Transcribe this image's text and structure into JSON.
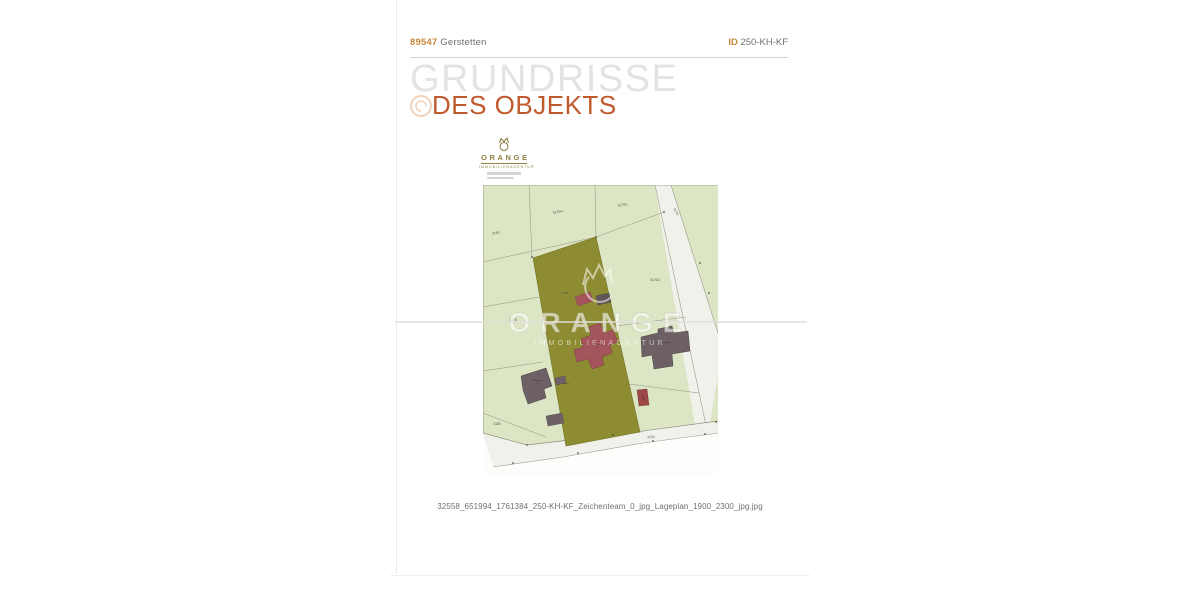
{
  "header": {
    "zip": "89547",
    "city": "Gerstetten",
    "id_label": "ID",
    "id_value": "250-KH-KF"
  },
  "title": {
    "line1": "GRUNDRISSE",
    "line2": "DES OBJEKTS"
  },
  "logo": {
    "name": "ORANGE",
    "subtitle": "IMMOBILIENAGENTUR"
  },
  "watermark": {
    "name": "ORANGE",
    "subtitle": "IMMOBILIENAGENTUR"
  },
  "caption": "32558_651994_1761384_250-KH-KF_Zeichenteam_0_jpg_Lageplan_1900_2300_jpg.jpg",
  "colors": {
    "accent_orange": "#c05a2c",
    "accent_gold": "#c8883c",
    "title_gray": "#e3e3e1",
    "text_gray": "#6f6f6f",
    "logo_olive": "#8f8040",
    "map_green": "#dde6c4",
    "map_olive": "#8e8c33",
    "map_road": "#f1f1ec",
    "map_line": "#8f9180",
    "building_maroon": "#a4555c",
    "building_gray": "#6d6166",
    "building_red": "#9d4747",
    "map_label": "#565747"
  },
  "siteplan": {
    "labels": [
      {
        "t": "3176/4",
        "x": 75,
        "y": 28,
        "s": 3.4,
        "r": -9,
        "c": "#565747"
      },
      {
        "t": "3176/1",
        "x": 140,
        "y": 21,
        "s": 3.4,
        "r": -9,
        "c": "#565747"
      },
      {
        "t": "3179",
        "x": 192,
        "y": 27,
        "s": 3.4,
        "r": 62,
        "c": "#565747"
      },
      {
        "t": "3180",
        "x": 13,
        "y": 49,
        "s": 3.4,
        "r": -9,
        "c": "#565747"
      },
      {
        "t": "3176/2",
        "x": 172,
        "y": 96,
        "s": 3.4,
        "r": 0,
        "c": "#565747"
      },
      {
        "t": "3178",
        "x": 30,
        "y": 136,
        "s": 3.4,
        "r": 0,
        "c": "#565747"
      },
      {
        "t": "3178",
        "x": 82,
        "y": 109,
        "s": 3.0,
        "r": 0,
        "c": "#565747"
      },
      {
        "t": "3180",
        "x": 14,
        "y": 240,
        "s": 3.4,
        "r": 0,
        "c": "#565747"
      },
      {
        "t": "3204",
        "x": 168,
        "y": 253,
        "s": 3.4,
        "r": -4,
        "c": "#565747"
      },
      {
        "t": "Birkenweg",
        "x": 55,
        "y": 196,
        "s": 2.1,
        "r": 0,
        "c": "#362f32"
      },
      {
        "t": "18",
        "x": 55,
        "y": 199,
        "s": 2.1,
        "r": 0,
        "c": "#362f32"
      },
      {
        "t": "Birkenweg",
        "x": 114,
        "y": 160,
        "s": 2.1,
        "r": 0,
        "c": "#362f32"
      },
      {
        "t": "22",
        "x": 114,
        "y": 163.5,
        "s": 2.1,
        "r": 0,
        "c": "#362f32"
      },
      {
        "t": "Birkenweg",
        "x": 182,
        "y": 158,
        "s": 2.1,
        "r": 0,
        "c": "#362f32"
      },
      {
        "t": "2",
        "x": 182,
        "y": 161.5,
        "s": 2.1,
        "r": 0,
        "c": "#362f32"
      },
      {
        "t": "Garage",
        "x": 83,
        "y": 199,
        "s": 1.8,
        "r": 0,
        "c": "#362f32"
      },
      {
        "t": "Garage",
        "x": 160,
        "y": 213,
        "s": 1.8,
        "r": 80,
        "c": "#2e1e1e"
      }
    ],
    "survey_points": [
      [
        181,
        27
      ],
      [
        113,
        52
      ],
      [
        49,
        72
      ],
      [
        217,
        78
      ],
      [
        226,
        108
      ],
      [
        30,
        278
      ],
      [
        95,
        268
      ],
      [
        170,
        256
      ],
      [
        222,
        249
      ],
      [
        44,
        260
      ],
      [
        130,
        250
      ],
      [
        233,
        237
      ]
    ]
  }
}
